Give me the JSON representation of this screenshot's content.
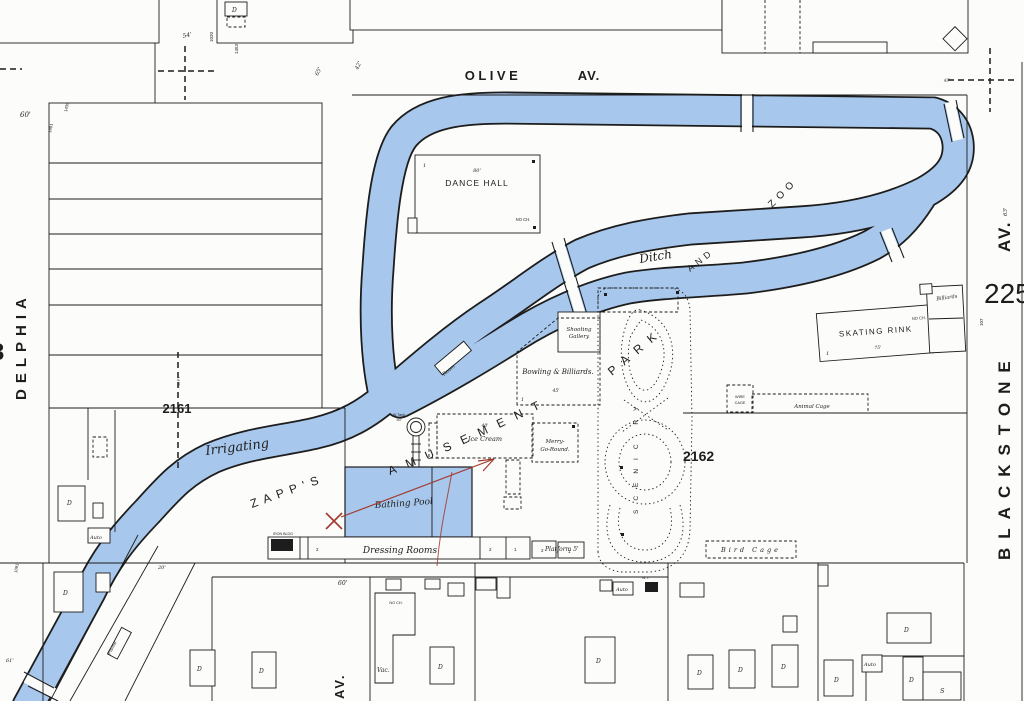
{
  "sheet": {
    "number": "225"
  },
  "blocks": {
    "b2161": "2161",
    "b2162": "2162",
    "partial": "3"
  },
  "streets": {
    "olive": "OLIVE",
    "av": "AV.",
    "delphia": "DELPHIA",
    "blackstone": "BLACKSTONE"
  },
  "park": {
    "zapps": "ZAPP'S",
    "amusement": "AMUSEMENT",
    "park": "PARK",
    "and": "AND",
    "zoo": "ZOO",
    "scenic": "SCENIC RY"
  },
  "water": {
    "irrigating": "Irrigating",
    "ditch": "Ditch"
  },
  "bld": {
    "dance_hall": "DANCE HALL",
    "skating_rink": "SKATING RINK",
    "billiards": "Billiards",
    "shooting1": "Shooting",
    "shooting2": "Gallery",
    "bowling": "Bowling & Billiards.",
    "ice_cream": "Ice Cream",
    "merry1": "Merry-",
    "merry2": "Go-Round.",
    "bathing_pool": "Bathing Pool",
    "dressing_rooms": "Dressing Rooms",
    "platform": "Platform 5'",
    "bird_cage": "Bird Cage",
    "animal_cage": "Animal Cage",
    "wire1": "WIRE",
    "wire2": "CAGE",
    "room": "Room",
    "wtank": "W.Tank",
    "flume": "Flume",
    "iron": "IRON BLDG",
    "vac": "Vac.",
    "auto": "Auto",
    "wt": "W.T.",
    "dwelling": "D",
    "store": "S"
  },
  "dims": {
    "no_ch": "NO CH.",
    "d54": "54'",
    "d60": "60'",
    "d61": "61'",
    "d63": "63'",
    "d65": "65'",
    "d42": "42'",
    "d75": "75'",
    "d80": "80'",
    "d40": "40'",
    "d45": "45'",
    "d50": "50'",
    "d20": "20'",
    "d107": "107",
    "n1453": "1453",
    "n1020": "1020",
    "n1435": "1435",
    "n1491": "1491",
    "n1091": "1091",
    "n740": "740 FT",
    "s1": "1",
    "s2": "2"
  },
  "colors": {
    "water": "#a8c7ec",
    "ink": "#1d1d1d",
    "annotation": "#a3382c",
    "paper": "#fcfcfa"
  }
}
